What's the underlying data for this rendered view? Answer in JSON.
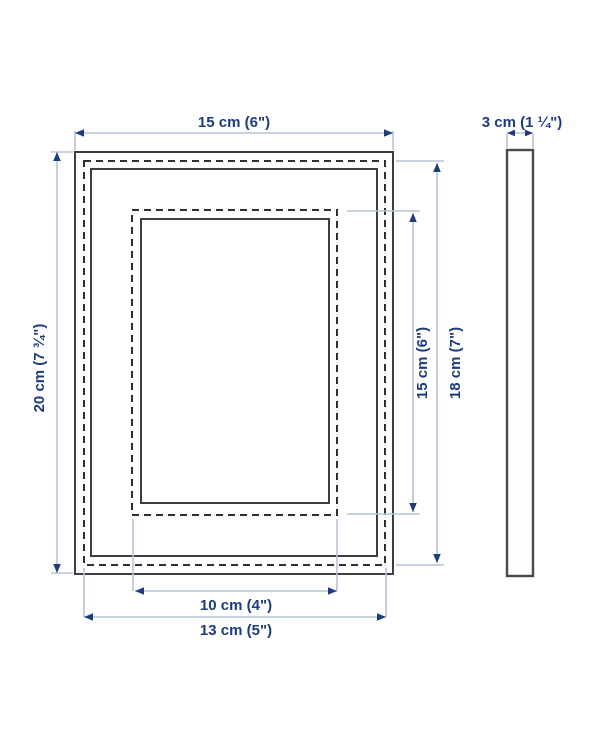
{
  "diagram": {
    "kind": "picture-frame-dimension-diagram",
    "front_view": {
      "overall_width": {
        "label": "15 cm (6\")"
      },
      "overall_height": {
        "label": "20 cm (7 ¾\")"
      },
      "opening_height": {
        "label": "15 cm (6\")"
      },
      "glass_height": {
        "label": "18 cm (7\")"
      },
      "opening_width": {
        "label": "10 cm (4\")"
      },
      "glass_width": {
        "label": "13 cm (5\")"
      }
    },
    "side_view": {
      "depth": {
        "label": "3 cm (1 ¼\")"
      }
    },
    "colors": {
      "dimension_text": "#1d3c7d",
      "dimension_line": "#b6c4d7",
      "arrowhead": "#1d3c7d",
      "frame_outline": "#3d3d3d",
      "background": "#ffffff"
    }
  }
}
